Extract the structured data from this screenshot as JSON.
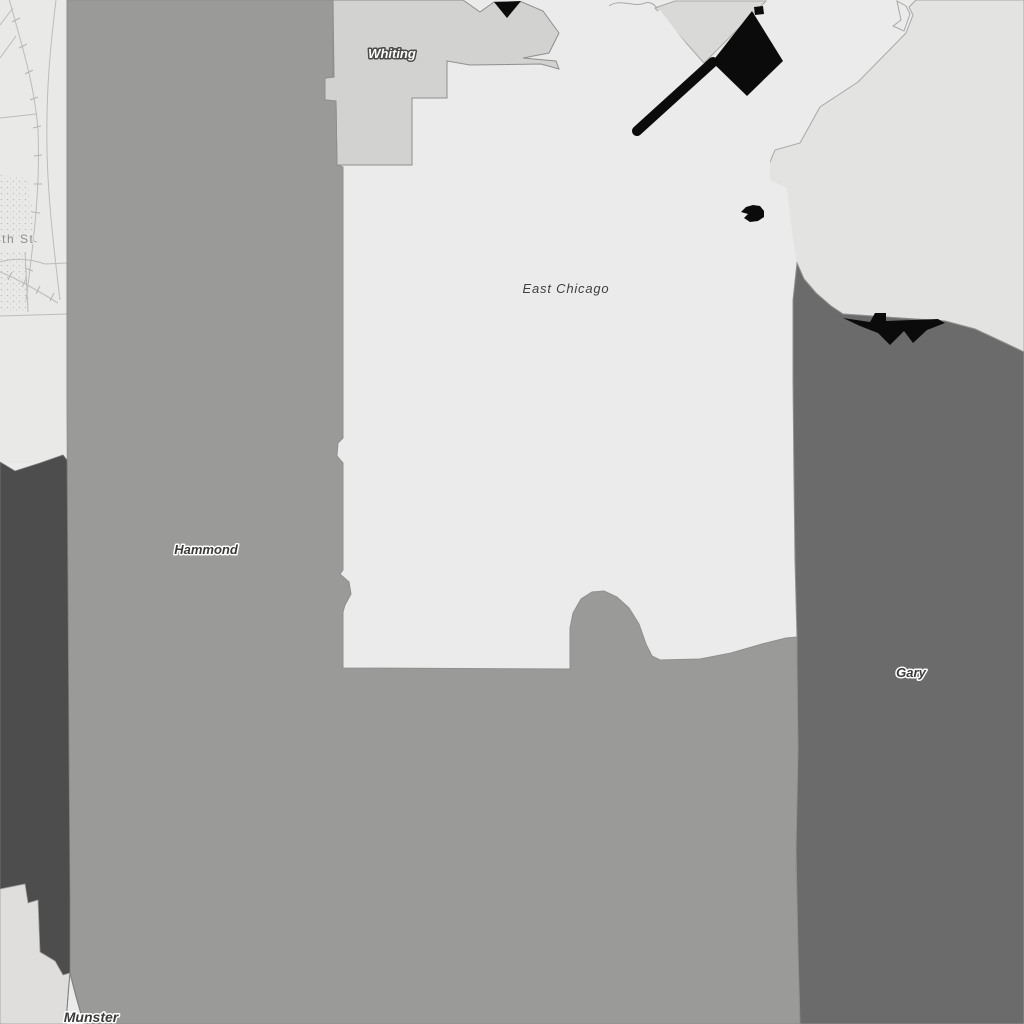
{
  "map": {
    "regions": [
      {
        "id": "whiting",
        "label": "Whiting",
        "fill": "#d2d2d0"
      },
      {
        "id": "east-chicago",
        "label": "East Chicago",
        "fill": "#ebebeb"
      },
      {
        "id": "hammond",
        "label": "Hammond",
        "fill": "#9a9a98"
      },
      {
        "id": "gary",
        "label": "Gary",
        "fill": "#6b6b6b"
      },
      {
        "id": "munster",
        "label": "Munster",
        "fill": "#9a9a98"
      }
    ],
    "street_labels": [
      {
        "id": "fourth-st",
        "label": "4th St"
      }
    ],
    "other_fills": {
      "background": "#ebebeb",
      "lakefront_area": "#e3e3e1",
      "wedge_area": "#d9d9d7",
      "notch_area": "#ebebeb",
      "dark_area": "#4d4d4d",
      "bottom_left_area": "#dfdedc",
      "basemap": "#e9e9e7",
      "black_features": "#0b0b0b"
    }
  }
}
